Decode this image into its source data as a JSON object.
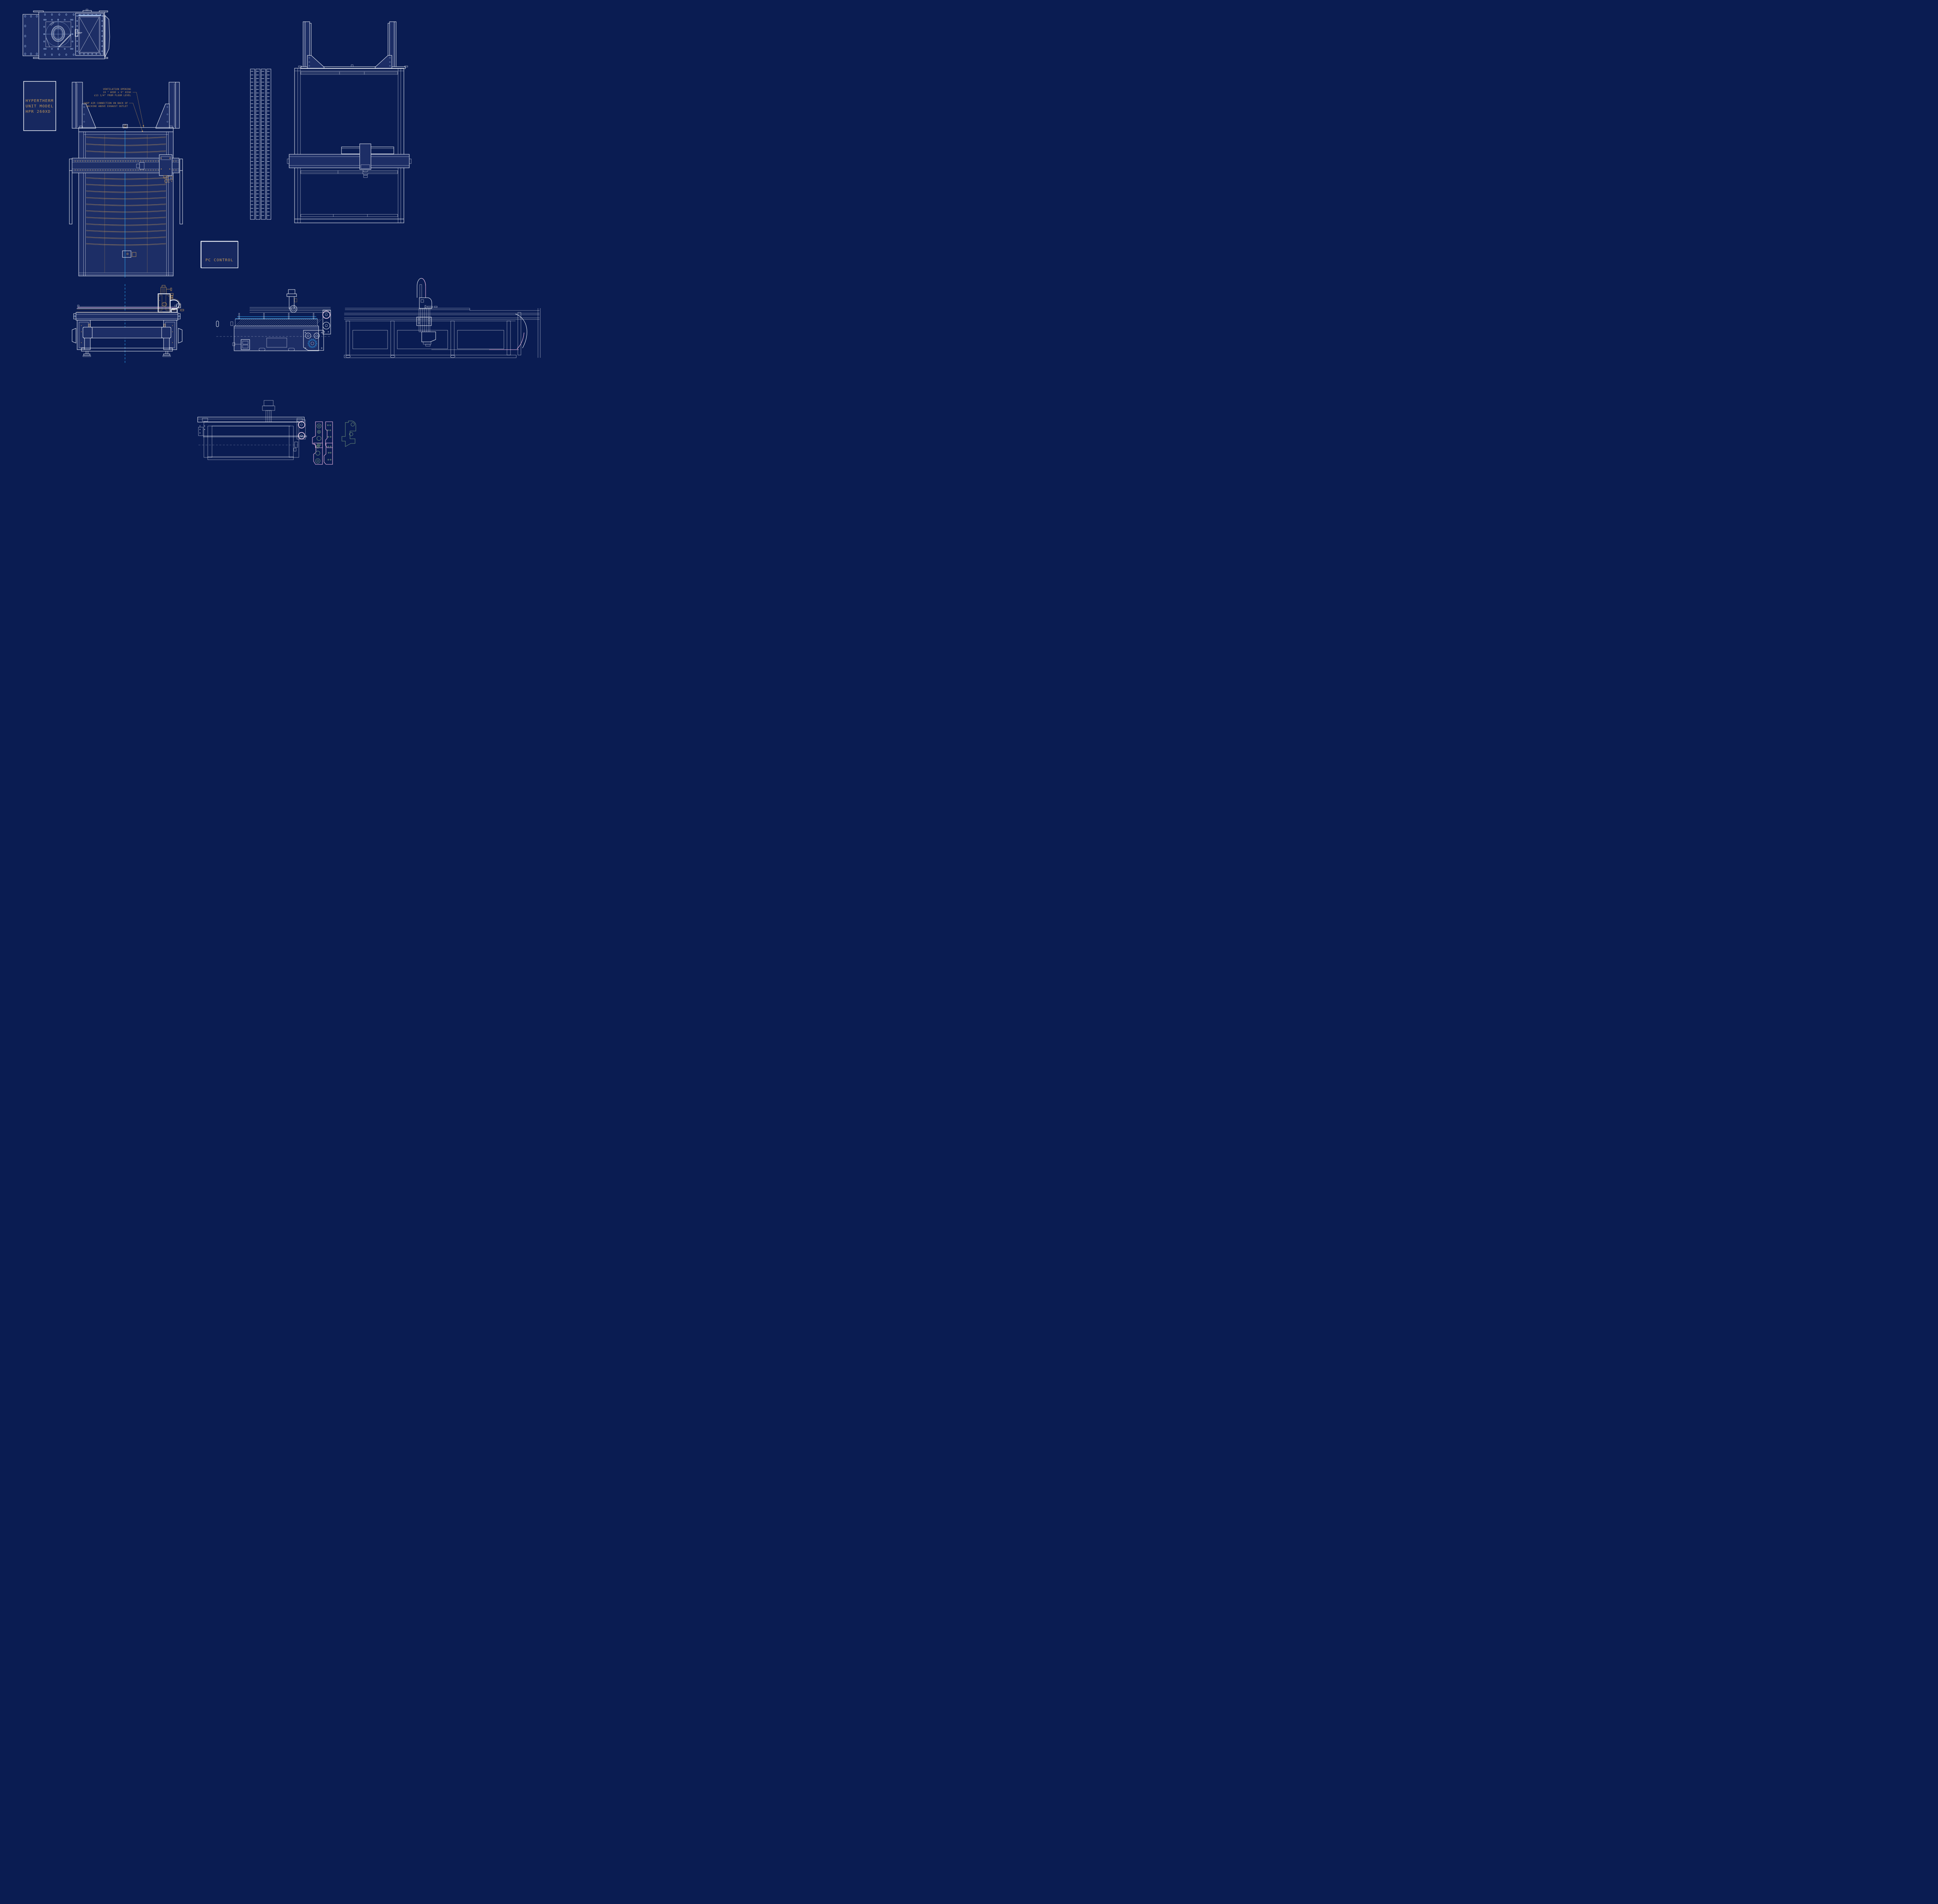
{
  "drawing": {
    "type": "cad-blueprint",
    "subject": "CNC plasma cutting machine orthographic views"
  },
  "colors": {
    "background": "#0a1c52",
    "panel_fill": "#1d2e66",
    "line_white": "#f2f5fb",
    "line_light_blue": "#a9c4ee",
    "accent_gold": "#c49858",
    "accent_cyan": "#2da7f5",
    "accent_pink": "#f2bbe5",
    "accent_teal": "#6f8f78"
  },
  "hypertherm_box": {
    "line1": "HYPERTHERM",
    "line2": "UNIT MODEL",
    "line3": "HPR 260XD"
  },
  "pc_control_box": {
    "label": "PC CONTROL"
  },
  "annotations": {
    "ventilation": {
      "line1": "VENTILATION OPENING",
      "line2": "19 \"  WIDE x 9\" HIGH",
      "line3": "¢13 1/4\" FROM FLOOR LEVEL"
    },
    "shop_air": {
      "line1": "SHOP AIR CONNECTION ON BACK OF",
      "line2": "MACHINE ABOVE EXHAUST OUTLET"
    }
  }
}
